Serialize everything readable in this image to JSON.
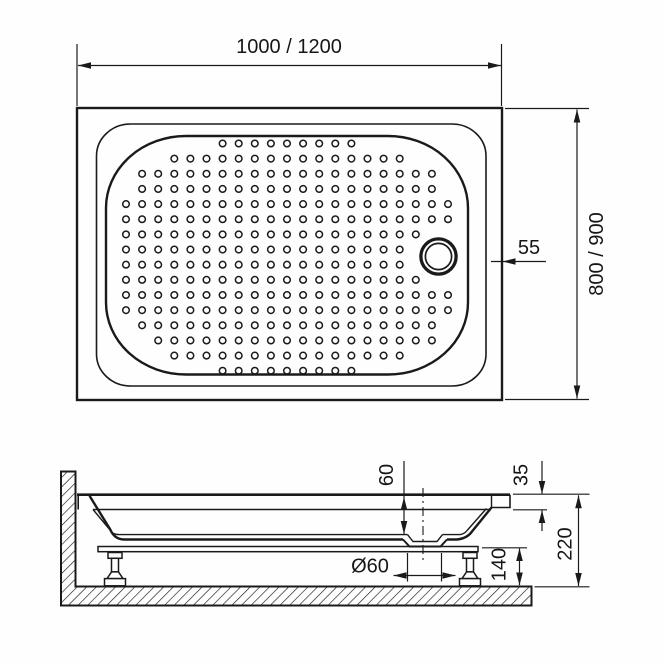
{
  "drawing": {
    "type": "shower-tray technical drawing",
    "views": {
      "top_view": {
        "labels": {
          "top_width": "1000 / 1200",
          "side_depth": "800 / 900",
          "drain_offset": "55"
        }
      },
      "section_view": {
        "labels": {
          "basin_depth": "60",
          "rim_height": "35",
          "total_height": "220",
          "frame_height": "140",
          "drain_diameter": "Ø60"
        }
      }
    },
    "colors": {
      "line": "#1a1a1a",
      "background": "#fefefe"
    }
  },
  "pattern": {
    "rows": 16,
    "cols": 21,
    "x0": 126,
    "y0": 143.5,
    "dx": 16.1,
    "dy": 15.15,
    "r": 3.3,
    "cx": 287.5,
    "cy": 257,
    "a": 166,
    "b": 116,
    "n": 3.2,
    "drain_x": 438.5,
    "drain_y": 256.5,
    "drain_r": 28.5
  }
}
